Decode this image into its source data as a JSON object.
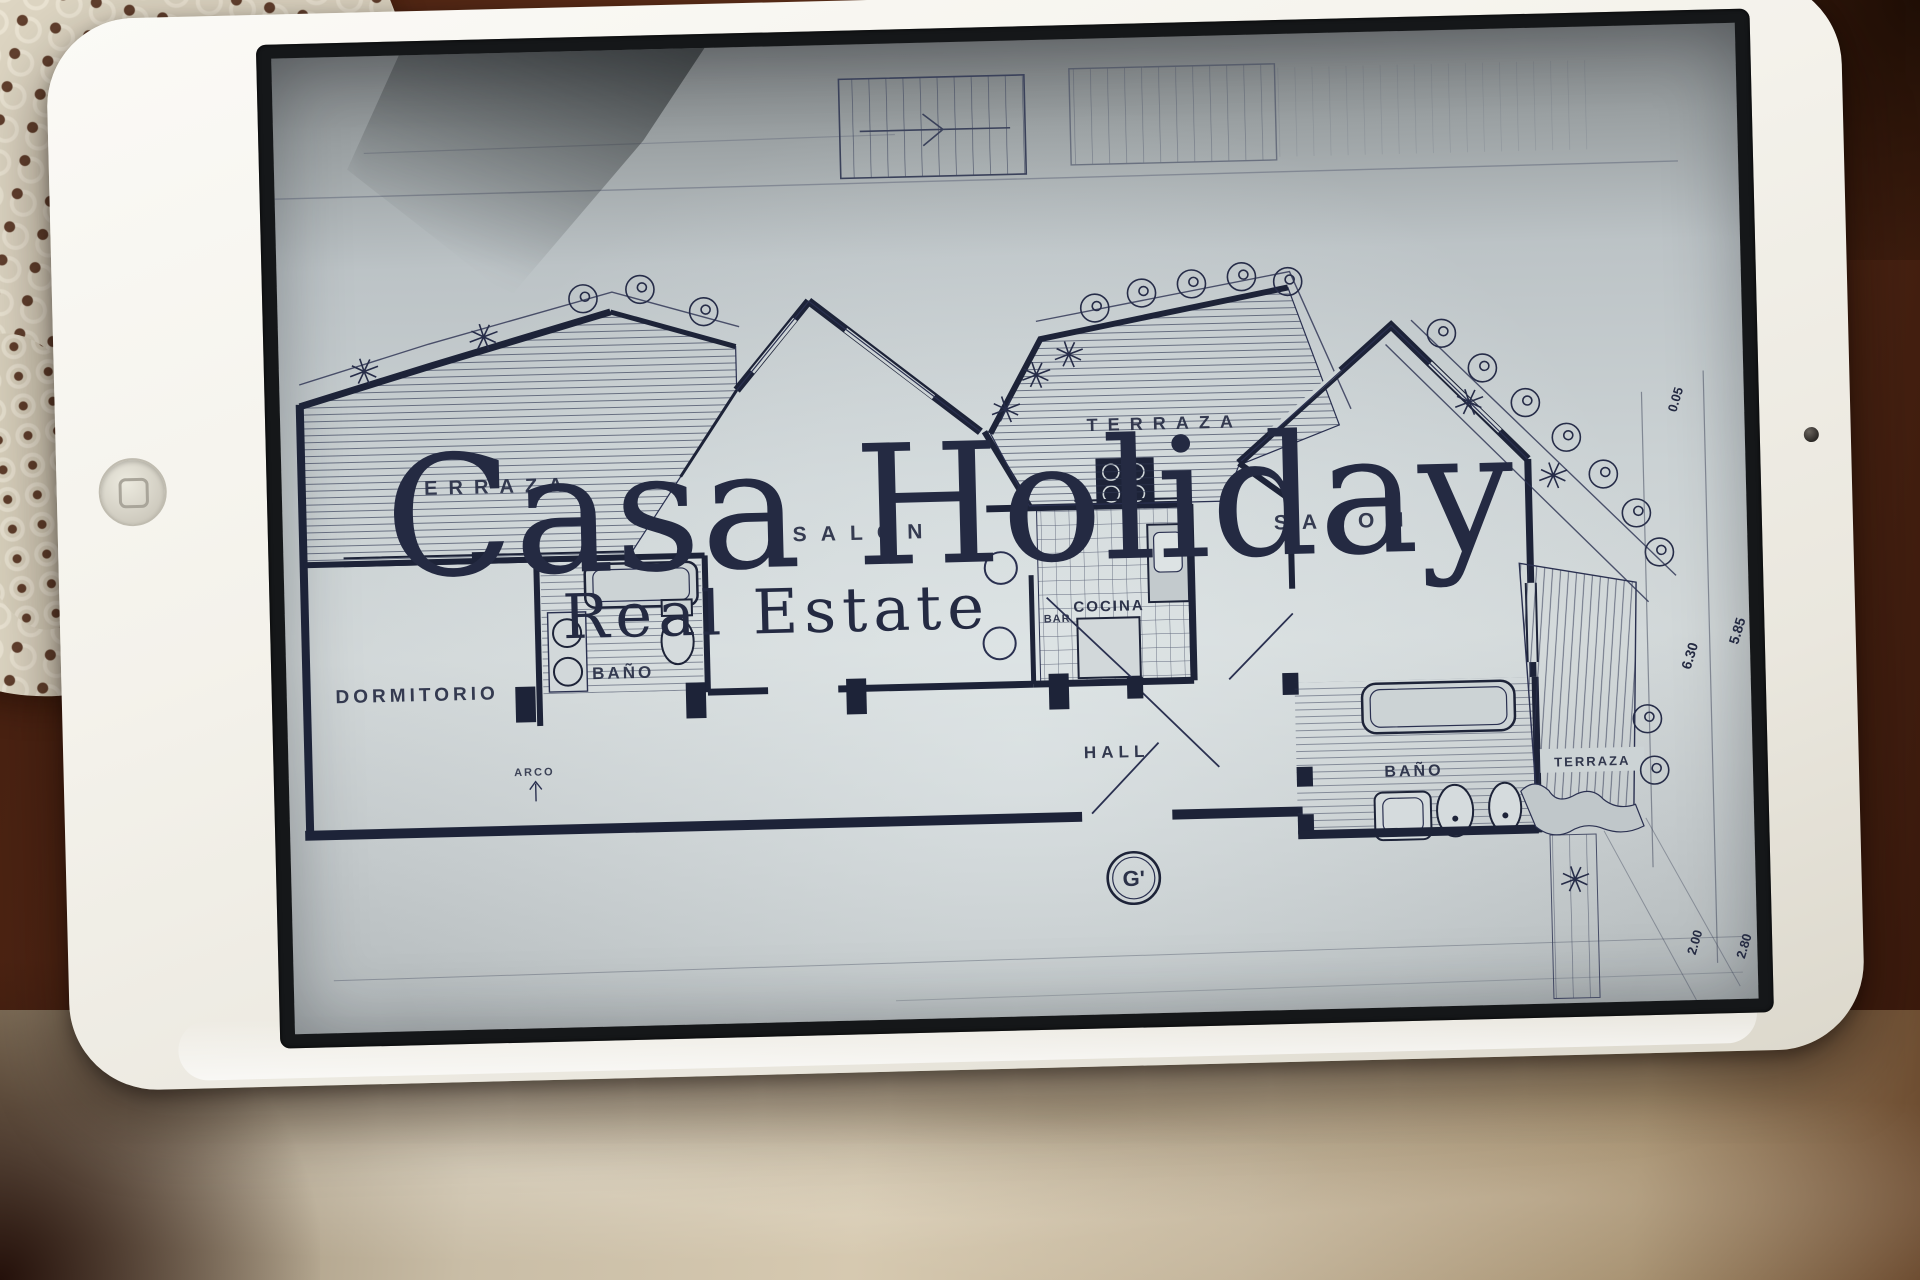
{
  "watermark": {
    "line1": "Casa Holiday",
    "line2": "Real Estate"
  },
  "plan": {
    "labels": {
      "terraza_left": "TERRAZA",
      "terraza_mid": "TERRAZA",
      "terraza_right": "TERRAZA",
      "dormitorio": "DORMITORIO",
      "bano_left": "BAÑO",
      "bano_right": "BAÑO",
      "salon_left": "SALON",
      "salon_right": "SALON",
      "cocina": "COCINA",
      "bar": "BAR",
      "hall": "HALL",
      "arco": "ARCO",
      "marker": "G'"
    },
    "dimensions": {
      "d1": "0.05",
      "d2": "6.30",
      "d3": "5.85",
      "d4": "2.00",
      "d5": "2.80"
    }
  }
}
